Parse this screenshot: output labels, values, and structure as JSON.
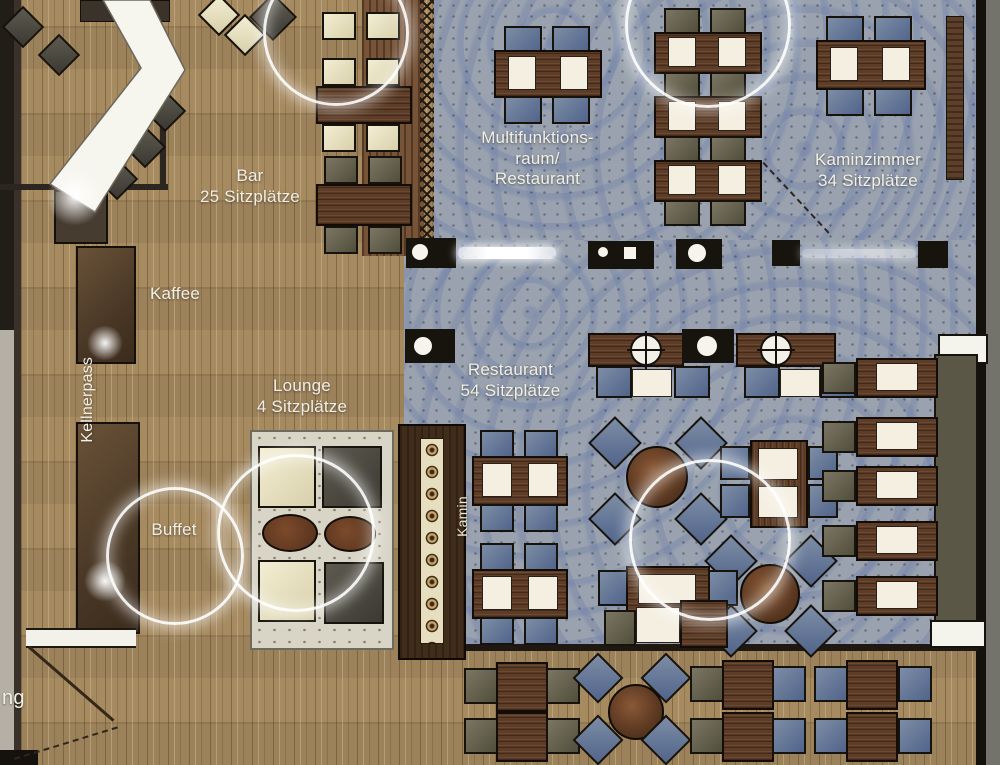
{
  "plan": {
    "rooms": {
      "bar": {
        "name": "Bar",
        "seats": "25 Sitzplätze"
      },
      "multifunktionsraum": {
        "line1": "Multifunktions-",
        "line2": "raum/",
        "line3": "Restaurant"
      },
      "kaminzimmer": {
        "name": "Kaminzimmer",
        "seats": "34 Sitzplätze"
      },
      "restaurant": {
        "name": "Restaurant",
        "seats": "54 Sitzplätze"
      },
      "lounge": {
        "name": "Lounge",
        "seats": "4 Sitzplätze"
      }
    },
    "stations": {
      "kaffee": "Kaffee",
      "buffet": "Buffet",
      "kellnerpass": "Kellnerpass",
      "kamin": "Kamin"
    },
    "partial_label": "ng"
  },
  "colors": {
    "wood_floor": "#a68a60",
    "stone_floor": "#99a2ae",
    "table_wood": "#5e3c25",
    "placemat": "#f4efe1",
    "chair_blue": "#5f7392",
    "chair_olive": "#6e6a56",
    "chair_cream": "#ece6c9",
    "counter_white": "#f6f5ee",
    "wall_dark": "#1f1b15",
    "light_ring": "#ffffff"
  }
}
